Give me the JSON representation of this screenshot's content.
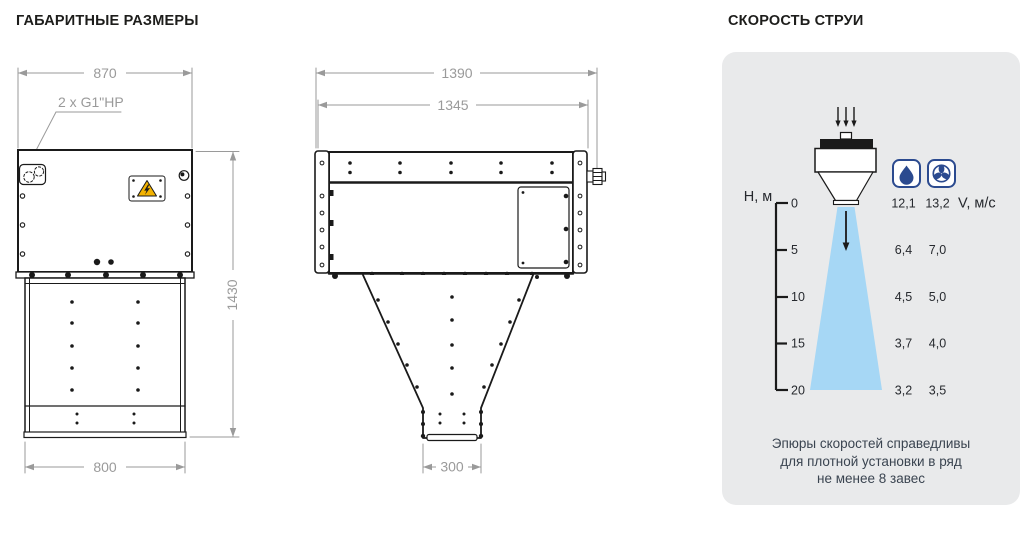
{
  "titles": {
    "dimensions": "ГАБАРИТНЫЕ РАЗМЕРЫ",
    "velocity": "СКОРОСТЬ СТРУИ"
  },
  "front_view": {
    "dim_width_top": "870",
    "pipe_label": "2 x G1\"HP",
    "dim_height": "1430",
    "dim_width_bottom": "800"
  },
  "side_view": {
    "dim_width_overall": "1390",
    "dim_width_body": "1345",
    "dim_outlet_width": "300"
  },
  "velocity_panel": {
    "height_axis_label": "H, м",
    "velocity_unit_label": "V, м/с",
    "height_ticks": [
      "0",
      "5",
      "10",
      "15",
      "20"
    ],
    "icons": [
      "water-drop-icon",
      "fan-icon"
    ],
    "water_values": [
      "12,1",
      "6,4",
      "4,5",
      "3,7",
      "3,2"
    ],
    "air_values": [
      "13,2",
      "7,0",
      "5,0",
      "4,0",
      "3,5"
    ],
    "note_line1": "Эпюры скоростей справедливы",
    "note_line2": "для плотной установки в ряд",
    "note_line3": "не менее 8 завес",
    "colors": {
      "panel_bg": "#e9eaeb",
      "jet": "#a6d7f5",
      "icon_navy": "#2b4a8f"
    }
  },
  "chart_data": {
    "type": "table",
    "title": "СКОРОСТЬ СТРУИ",
    "x_label": "H, м",
    "y_label": "V, м/с",
    "x": [
      0,
      5,
      10,
      15,
      20
    ],
    "series": [
      {
        "name": "water mode (drop icon)",
        "values": [
          12.1,
          6.4,
          4.5,
          3.7,
          3.2
        ]
      },
      {
        "name": "air mode (fan icon)",
        "values": [
          13.2,
          7.0,
          5.0,
          4.0,
          3.5
        ]
      }
    ],
    "note": "Эпюры скоростей справедливы для плотной установки в ряд не менее 8 завес"
  }
}
